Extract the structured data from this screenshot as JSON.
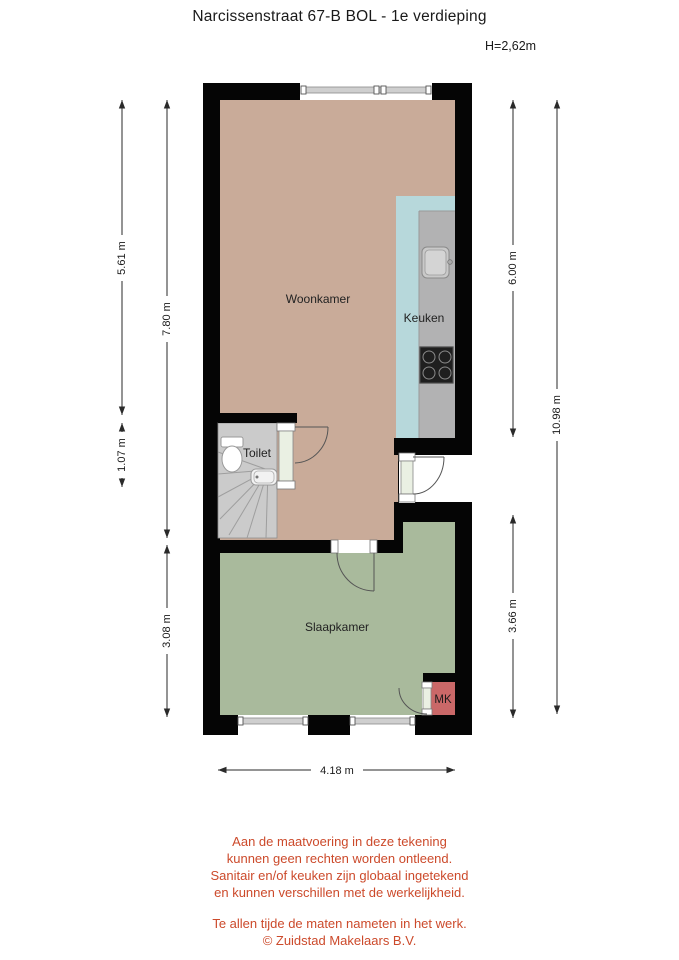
{
  "title": "Narcissenstraat 67-B BOL - 1e verdieping",
  "ceiling_height": "H=2,62m",
  "rooms": {
    "woonkamer": {
      "label": "Woonkamer"
    },
    "keuken": {
      "label": "Keuken"
    },
    "toilet": {
      "label": "Toilet"
    },
    "slaapkamer": {
      "label": "Slaapkamer"
    },
    "meterkast": {
      "label": "MK"
    }
  },
  "dimensions": {
    "woonkamer_left": "5.61 m",
    "toilet_left": "1.07 m",
    "upper_section_left": "7.80 m",
    "slaapkamer_left": "3.08 m",
    "upper_section_right": "6.00 m",
    "slaapkamer_right": "3.66 m",
    "total_right": "10.98 m",
    "total_width_bottom": "4.18 m"
  },
  "colors": {
    "wall": "#050505",
    "woonkamer_floor": "#c9ab99",
    "keuken_floor": "#b7d8db",
    "counter": "#b2b2b3",
    "toilet_floor": "#cbcbcb",
    "slaapkamer_floor": "#a9ba9c",
    "meterkast_floor": "#ca6868",
    "door_panel": "#eaf0e3",
    "disclaimer_text": "#cc4a2b"
  },
  "disclaimer": {
    "para1": [
      "Aan de maatvoering in deze tekening",
      "kunnen geen rechten worden ontleend.",
      "Sanitair en/of keuken zijn globaal ingetekend",
      "en kunnen verschillen met de werkelijkheid."
    ],
    "para2": [
      "Te allen tijde de maten nameten in het werk.",
      "© Zuidstad Makelaars B.V."
    ]
  }
}
